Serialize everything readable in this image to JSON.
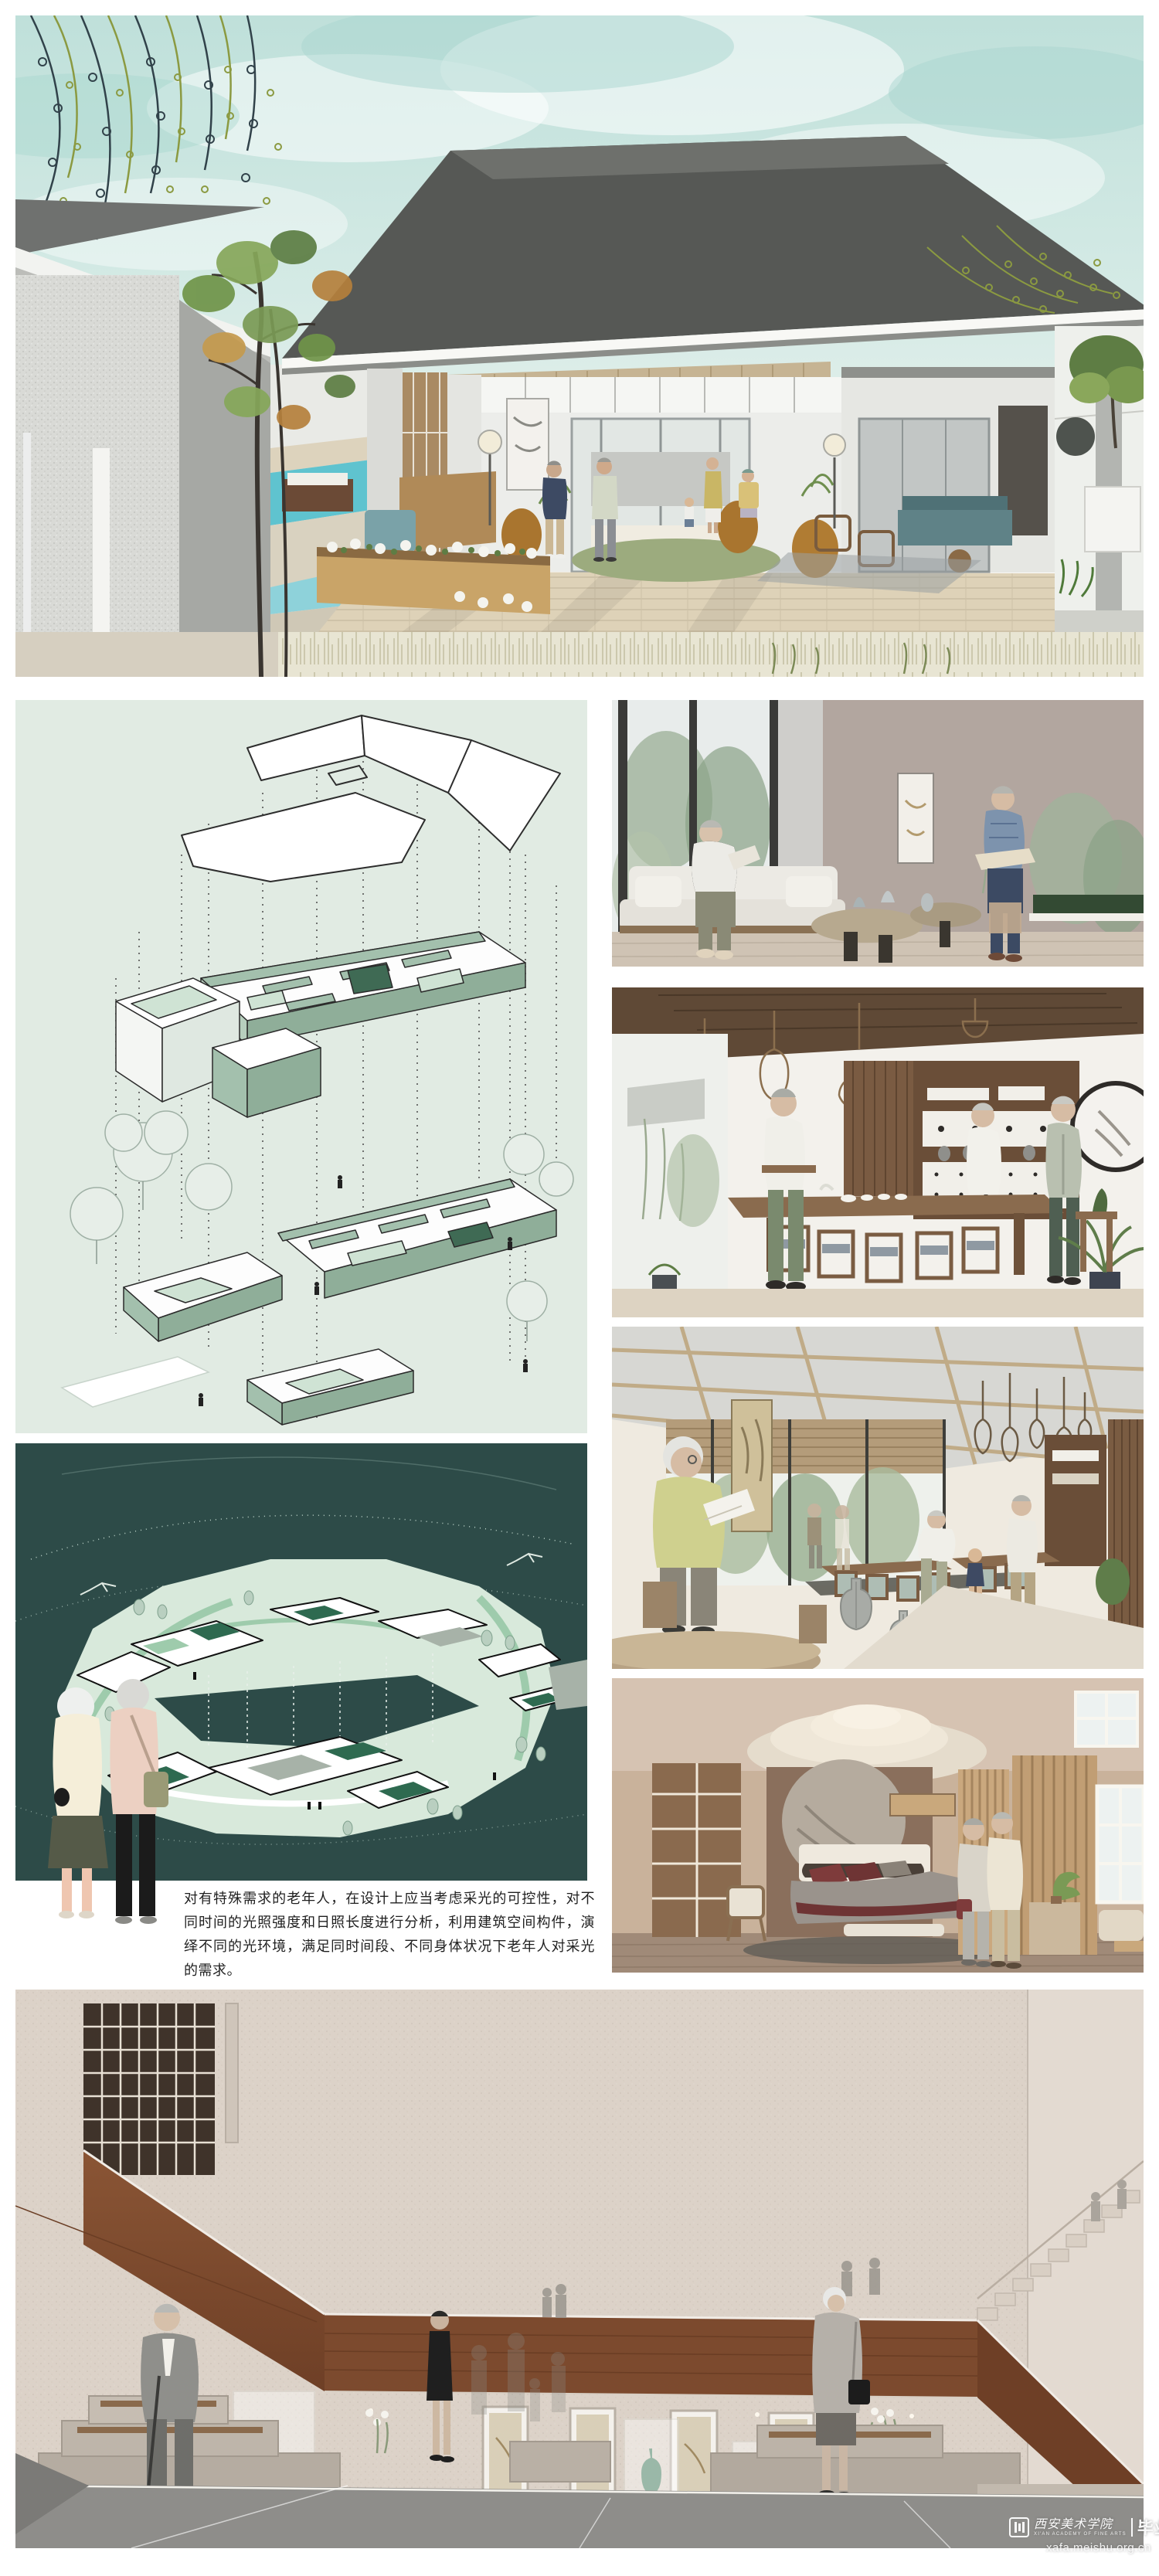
{
  "annotation": {
    "text": "对有特殊需求的老年人，在设计上应当考虑采光的可控性，对不同时间的光照强度和日照长度进行分析，利用建筑空间构件，演绎不同的光环境，满足同时间段、不同身体状况下老年人对采光的需求。"
  },
  "watermark": {
    "school_cn": "西安美术学院",
    "school_en": "XI'AN ACADEMY OF FINE ARTS",
    "exhibition": "毕业展",
    "url": "xafa.meishu.org.cn"
  },
  "palette": {
    "page_bg": "#ffffff",
    "sky_teal": "#c2e2dc",
    "roof_grey": "#565855",
    "concrete_speckle": "#d9dad6",
    "deck_wood": "#ded2b8",
    "pool_blue": "#5fc3cf",
    "willow_olive": "#8b9a41",
    "willow_dark": "#31424a",
    "axon_bg": "#e1ebe3",
    "axon_sage": "#a3c0ad",
    "axon_front": "#8fae99",
    "axon_dark_green": "#3f6a54",
    "siteplan_teal": "#2d4b48",
    "siteplan_land": "#d8e9db",
    "siteplan_path": "#9ecbac",
    "siteplan_roof_green": "#2e6a50",
    "lounge_wall_taupe": "#b0a49d",
    "tea_room_wood": "#6a4e38",
    "bedroom_tan": "#c9ad92",
    "hall_wall_beige": "#dcd2c8",
    "hall_wood_brown": "#7c4a2e",
    "hall_floor_grey": "#8e8d8a"
  }
}
